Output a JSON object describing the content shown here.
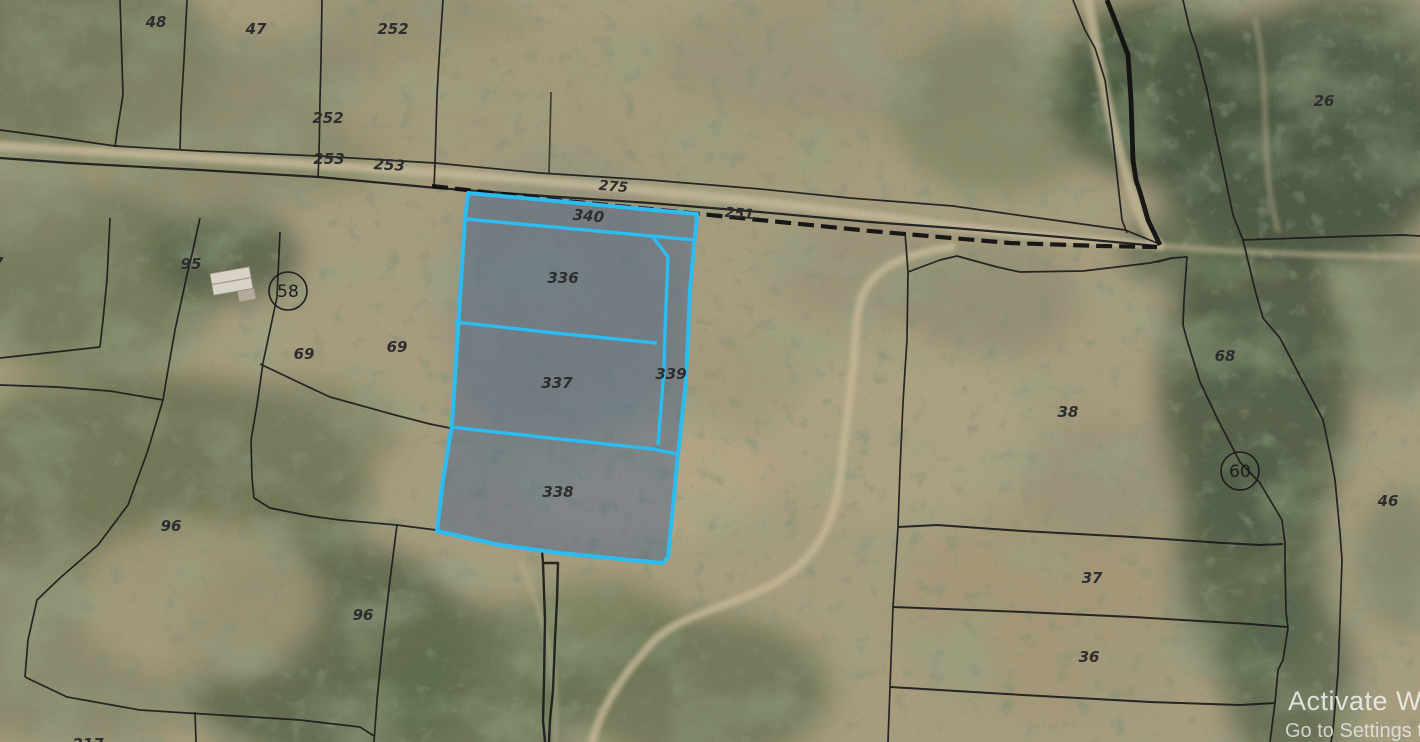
{
  "map": {
    "type": "cadastral-parcel-overlay-on-aerial-imagery",
    "labels": {
      "p48": "48",
      "p47": "47",
      "p252a": "252",
      "p252b": "252",
      "p253a": "253",
      "p253b": "253",
      "p275": "275",
      "p251": "251",
      "p340": "340",
      "p336": "336",
      "p337": "337",
      "p338": "338",
      "p339": "339",
      "p95": "95",
      "p58": "58",
      "p69a": "69",
      "p69b": "69",
      "p96a": "96",
      "p96b": "96",
      "p26": "26",
      "p68": "68",
      "p60": "60",
      "p46": "46",
      "p38": "38",
      "p37": "37",
      "p36": "36",
      "p17": "17",
      "p217": "217"
    },
    "highlighted_parcels": [
      "340",
      "336",
      "337",
      "338",
      "339"
    ],
    "circled_labels": [
      "58",
      "60"
    ],
    "colors": {
      "highlight_stroke": "#2bbcf2",
      "highlight_fill": "rgba(72,95,138,0.45)",
      "boundary": "#1b1b1b",
      "label": "#2d2d2d"
    }
  },
  "watermark": {
    "line1": "Activate Win",
    "line2": "Go to Settings to"
  }
}
